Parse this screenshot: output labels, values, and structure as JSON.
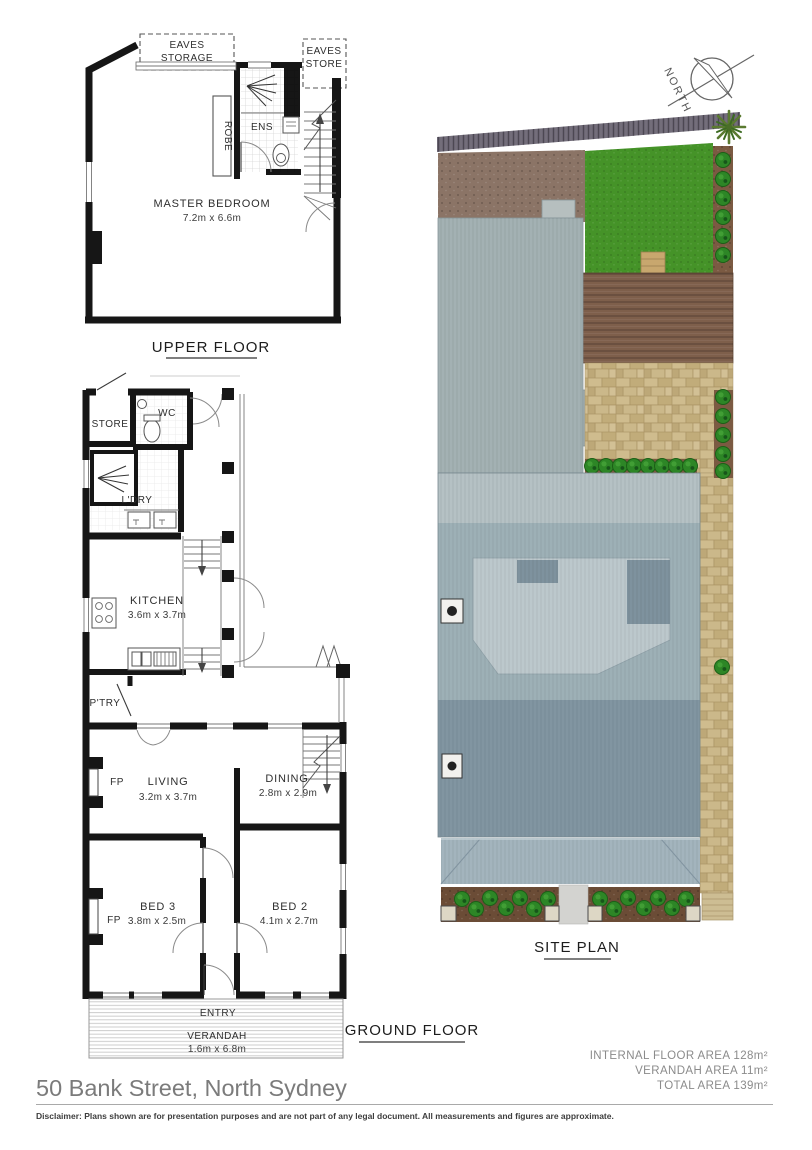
{
  "upper_floor": {
    "title": "UPPER FLOOR",
    "rooms": {
      "eaves_storage": {
        "line1": "EAVES",
        "line2": "STORAGE"
      },
      "eaves_store": {
        "line1": "EAVES",
        "line2": "STORE"
      },
      "robe": {
        "label": "ROBE"
      },
      "ens": {
        "label": "ENS"
      },
      "master_bedroom": {
        "label": "MASTER BEDROOM",
        "dims": "7.2m x 6.6m"
      }
    }
  },
  "ground_floor": {
    "title": "GROUND FLOOR",
    "rooms": {
      "store": {
        "label": "STORE"
      },
      "wc": {
        "label": "WC"
      },
      "laundry": {
        "label": "L'DRY"
      },
      "kitchen": {
        "label": "KITCHEN",
        "dims": "3.6m x 3.7m"
      },
      "pantry": {
        "label": "P'TRY"
      },
      "living": {
        "label": "LIVING",
        "dims": "3.2m x 3.7m"
      },
      "dining": {
        "label": "DINING",
        "dims": "2.8m x 2.9m"
      },
      "bed2": {
        "label": "BED 2",
        "dims": "4.1m x 2.7m"
      },
      "bed3": {
        "label": "BED 3",
        "dims": "3.8m x 2.5m"
      },
      "fireplace_living": {
        "label": "FP"
      },
      "fireplace_bed3": {
        "label": "FP"
      },
      "entry": {
        "label": "ENTRY"
      },
      "verandah": {
        "label": "VERANDAH",
        "dims": "1.6m x 6.8m"
      }
    }
  },
  "site_plan": {
    "title": "SITE PLAN",
    "north_label": "NORTH",
    "colors": {
      "fence": "#6a6472",
      "lawn": "#459328",
      "mulch": "#8b7466",
      "deck": "#7e5f4b",
      "bed_strip": "#7b5a42",
      "garden_bed": "#6b4c36",
      "garage_roof": "#a3b1b3",
      "roof_ridge": "#b5c1c4",
      "roof_mid": "#9db0b6",
      "roof_front": "#8195a1",
      "roof_feature": "#bcc8cc",
      "roof_feature_dark": "#7e929e",
      "verandah_roof": "#a3b4bd",
      "path": "#d3d3d0",
      "steps": "#c8a76e"
    }
  },
  "footer": {
    "address": "50 Bank Street, North Sydney",
    "areas": [
      "INTERNAL FLOOR AREA 128m²",
      "VERANDAH AREA 11m²",
      "TOTAL AREA 139m²"
    ],
    "disclaimer": "Disclaimer: Plans shown are for presentation purposes and are not part of any legal document. All measurements and figures are approximate."
  }
}
